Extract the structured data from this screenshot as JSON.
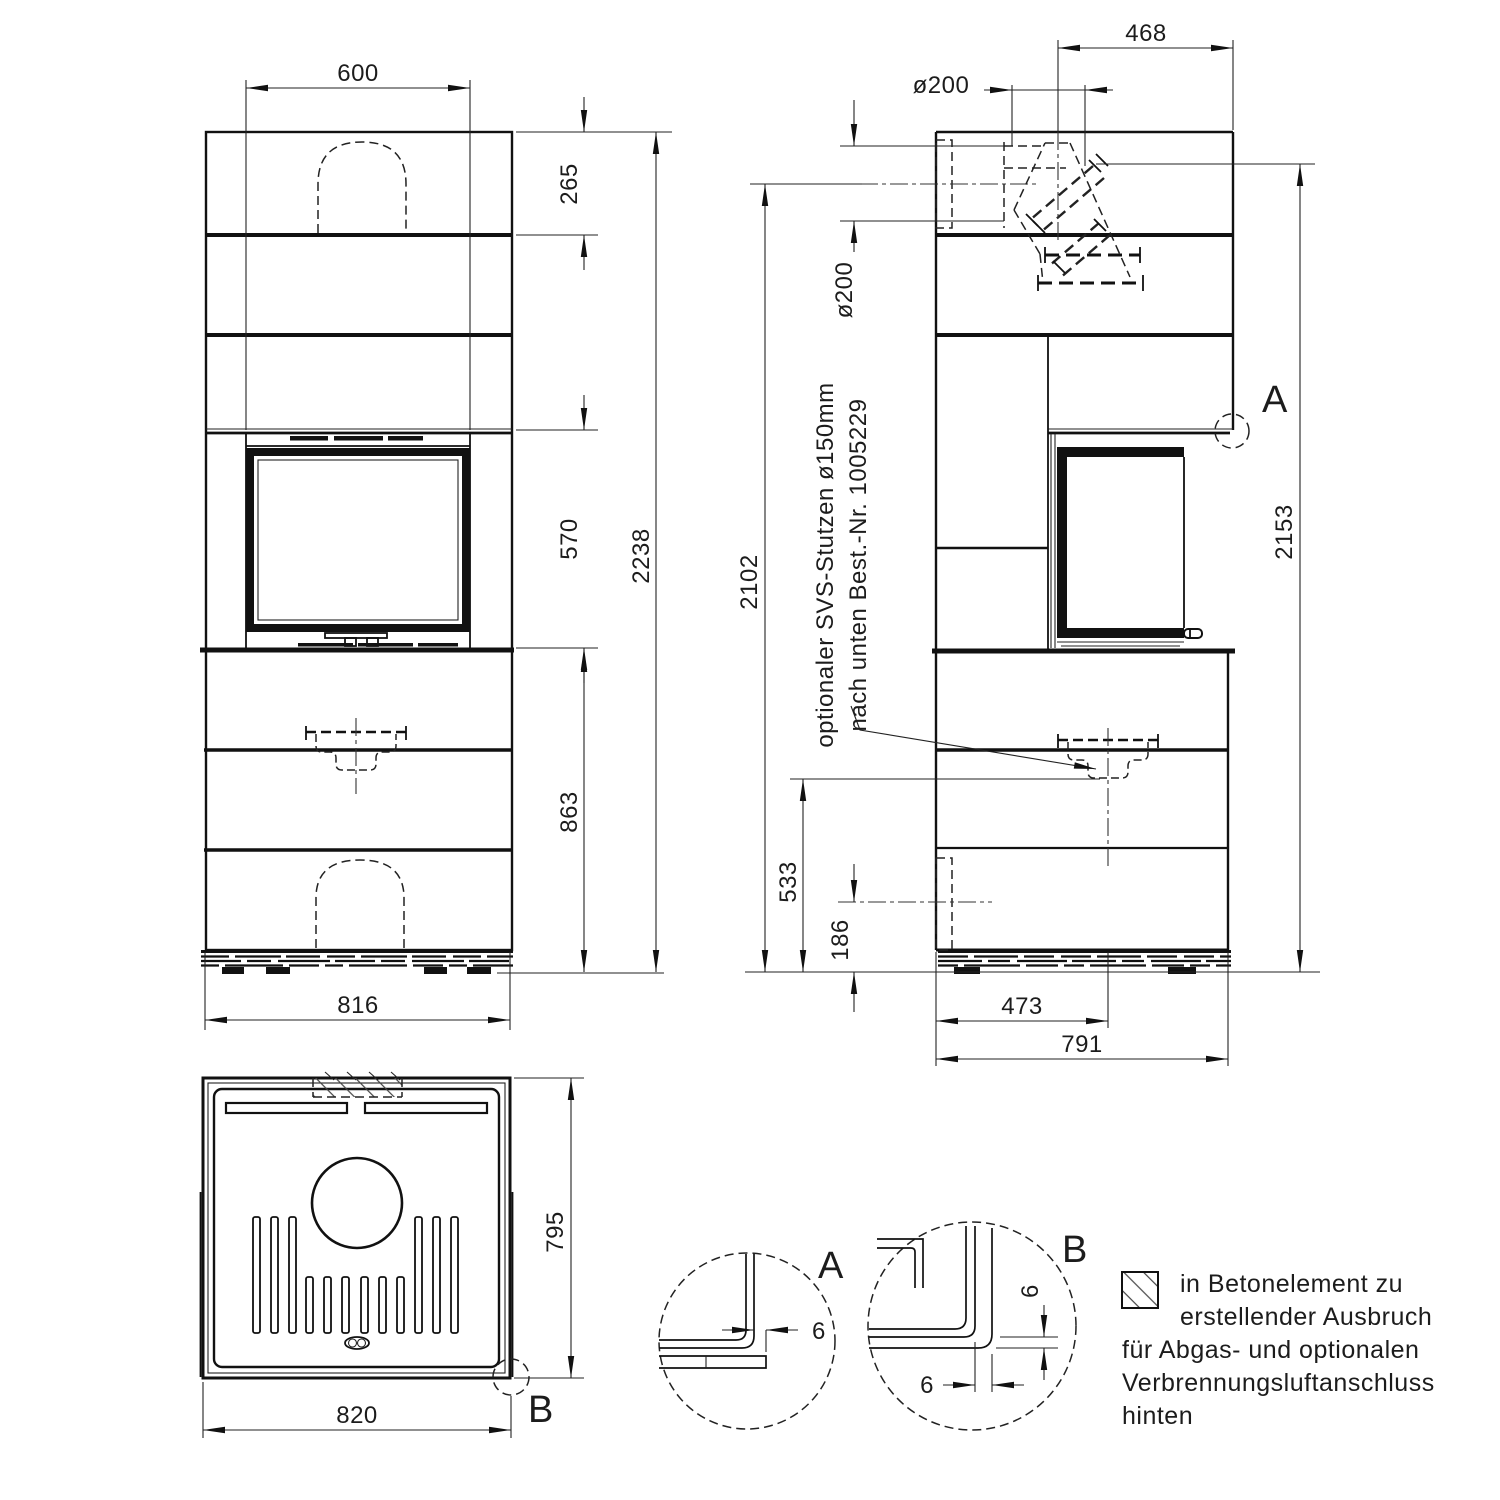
{
  "front_view": {
    "dim_top_width": "600",
    "dim_top_band_height": "265",
    "dim_door_height": "570",
    "dim_lower_height": "863",
    "dim_total_height": "2238",
    "dim_base_width": "816"
  },
  "side_view": {
    "dim_flue_offset": "468",
    "dim_flue_diameter_top": "ø200",
    "dim_rear_outlet_diameter": "ø200",
    "dim_height_rear_outlet": "2102",
    "dim_height_top": "2153",
    "dim_connector_height": "533",
    "dim_lower_outlet_height": "186",
    "dim_connector_offset": "473",
    "dim_depth": "791",
    "detail_ref": "A",
    "note_line1": "optionaler SVS-Stutzen ø150mm",
    "note_line2": "nach unten Best.-Nr. 1005229"
  },
  "top_view": {
    "dim_depth": "795",
    "dim_width": "820",
    "detail_ref": "B"
  },
  "detail_a": {
    "label": "A",
    "dim_gap": "6"
  },
  "detail_b": {
    "label": "B",
    "dim_gap_vertical": "6",
    "dim_gap_horizontal": "6"
  },
  "legend": {
    "line1": "in Betonelement zu",
    "line2": "erstellender Ausbruch",
    "line3": "für Abgas- und optionalen",
    "line4": "Verbrennungsluftanschluss",
    "line5": "hinten"
  }
}
